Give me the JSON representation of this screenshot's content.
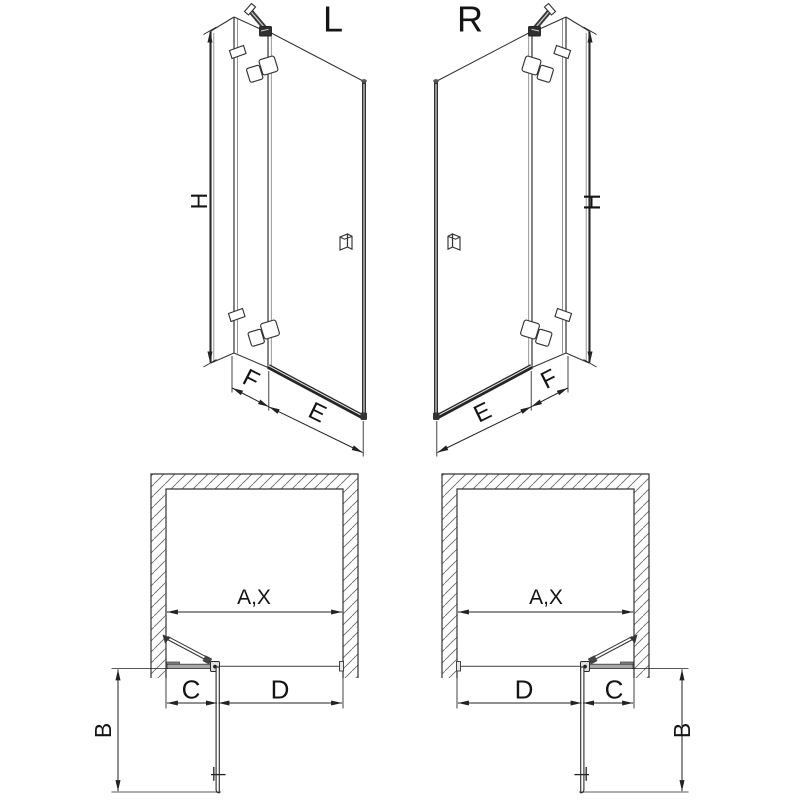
{
  "diagram_title": "shower-door-variants-technical-drawing",
  "colors": {
    "background": "#ffffff",
    "line": "#333333",
    "dim": "#222222",
    "light": "#8a8a8a",
    "rail": "#262626",
    "glass_gray": "#a8a8a8"
  },
  "views": {
    "perspective_left": {
      "label": "L",
      "dims": {
        "height": "H",
        "fixed": "F",
        "door": "E"
      }
    },
    "perspective_right": {
      "label": "R",
      "dims": {
        "height": "H",
        "fixed": "F",
        "door": "E"
      }
    },
    "plan_left": {
      "dims": {
        "opening": "A,X",
        "fixed": "C",
        "door": "D",
        "swing": "B"
      }
    },
    "plan_right": {
      "dims": {
        "opening": "A,X",
        "fixed": "C",
        "door": "D",
        "swing": "B"
      }
    }
  }
}
